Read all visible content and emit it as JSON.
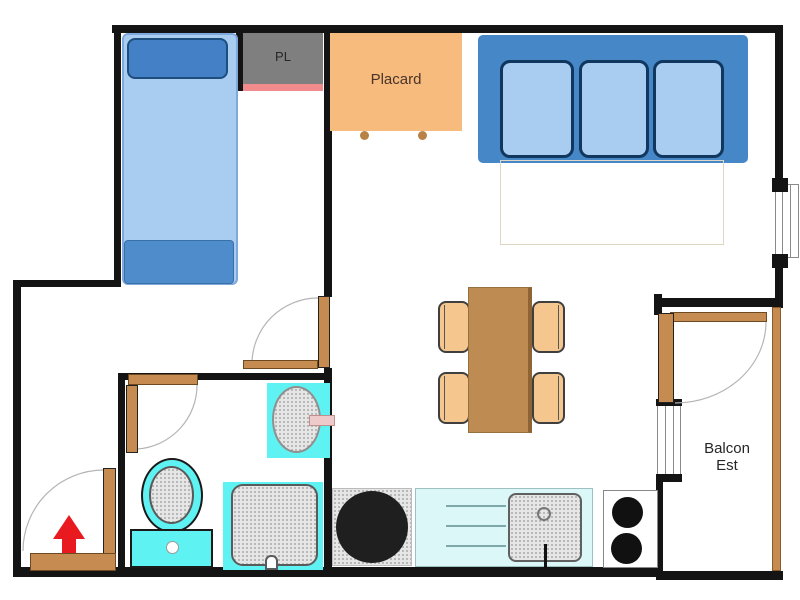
{
  "meta": {
    "type": "floor-plan",
    "description": "apartment floor plan, top view"
  },
  "labels": {
    "pl": "PL",
    "placard": "Placard",
    "balcony_line1": "Balcon",
    "balcony_line2": "Est"
  },
  "colors": {
    "wall": "#141414",
    "door_wood": "#C68B51",
    "bed_body": "#A9CDF1",
    "bed_pillow": "#4380C5",
    "sofa_back": "#4687C8",
    "cushion": "#A9CDF1",
    "cushion_border": "#12375F",
    "closet_grey": "#7F7F7F",
    "closet_pink_strip": "#F28C8C",
    "placard_orange": "#F7BB7D",
    "fixture_cyan": "#5FF2F2",
    "counter_cyan": "#DCF7F7",
    "table_brown": "#BE8B52",
    "chair_tan": "#F5C78E",
    "arrow_red": "#E8191F",
    "appliance_black": "#1F1F1F",
    "swing_arc_grey": "#b5b5b5"
  },
  "furniture": [
    "bed",
    "wardrobe-pl",
    "placard-cabinet",
    "sofa",
    "dining-table",
    "chairs",
    "round-appliance",
    "kitchen-counter-sink",
    "cooktop",
    "bathroom-sink",
    "toilet",
    "shower",
    "entrance-arrow"
  ]
}
